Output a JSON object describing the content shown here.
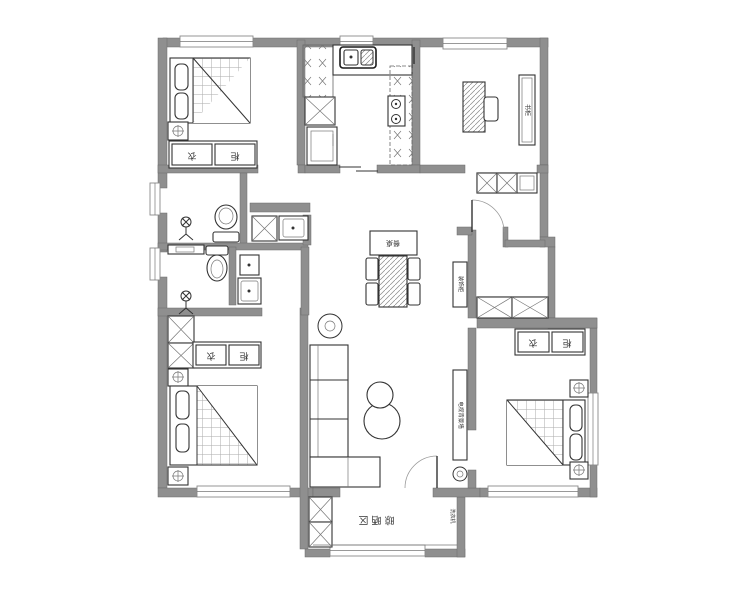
{
  "plan": {
    "labels": {
      "wardrobe_char_1": "衣",
      "wardrobe_char_2": "柜",
      "drying_area": "晾晒区",
      "dining_table": "餐桌",
      "bookshelf": "书柜",
      "entry_cabinet": "装饰柜",
      "tv_wall": "电视背景墙",
      "washing_machine": "洗衣机"
    },
    "colors": {
      "background": "#ffffff",
      "wall": "#8f8f8f",
      "line": "#333333",
      "hatch": "#999999"
    }
  }
}
